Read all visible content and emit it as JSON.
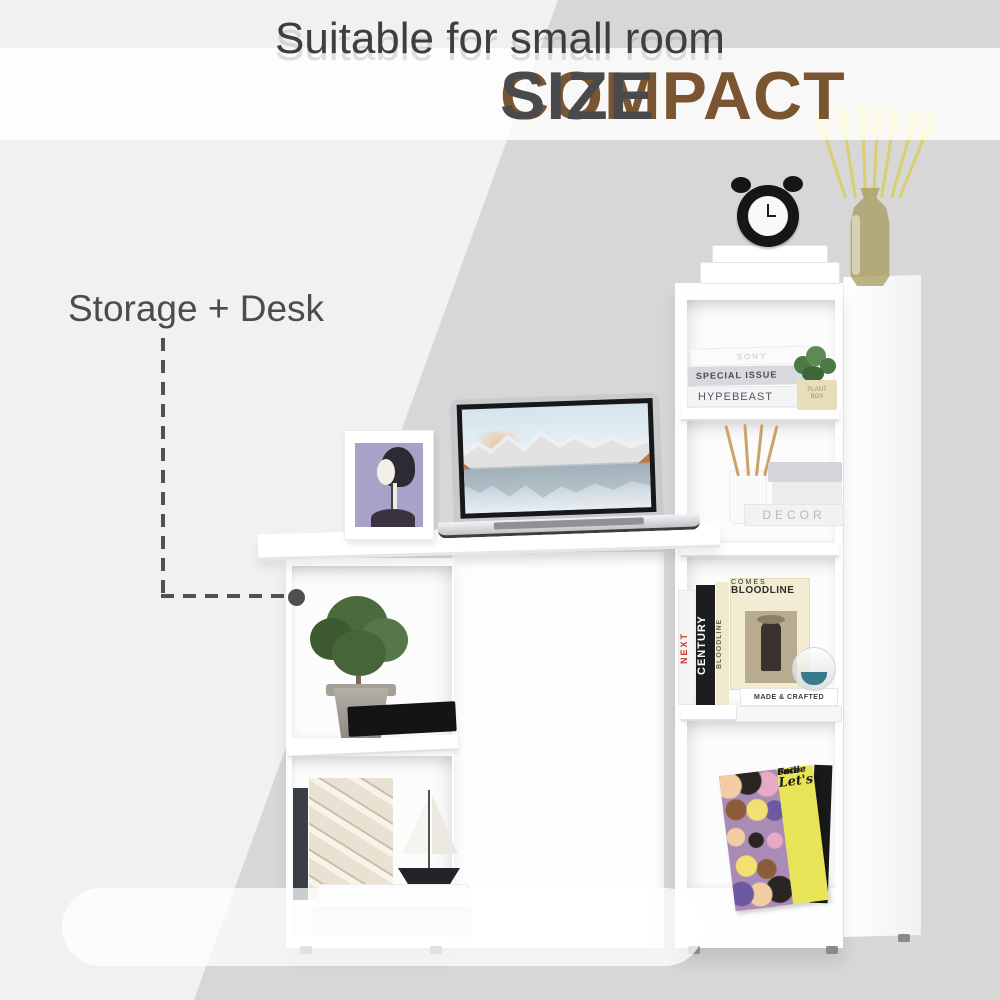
{
  "title": {
    "compact": "COMPACT ",
    "size": "SIZE"
  },
  "annotation": {
    "label": "Storage + Desk"
  },
  "caption": {
    "text": "Suitable for small room"
  },
  "colors": {
    "bg_dark": "#d8d7d8",
    "bg_light": "#f2f1f1",
    "title_brown": "#7a5531",
    "title_gray": "#4a494b",
    "text_gray": "#4c4c4e",
    "poster_yellow": "#e8e457"
  },
  "scene": {
    "top_shelf_books": [
      "SONY",
      "SPECIAL ISSUE",
      "HYPEBEAST"
    ],
    "plant_pot_label": "PLANT\nBOX",
    "decor_book": "DECOR",
    "spines": {
      "next": "NEXT",
      "century": "CENTURY",
      "bloodline": "BLOODLINE"
    },
    "cover": {
      "title": "BLOODLINE",
      "subtitle": "COMES"
    },
    "crafted_book": "MADE & CRAFTED",
    "poster_lines": [
      "Let's",
      "Put a",
      "Smile",
      "On That",
      "Face"
    ]
  }
}
